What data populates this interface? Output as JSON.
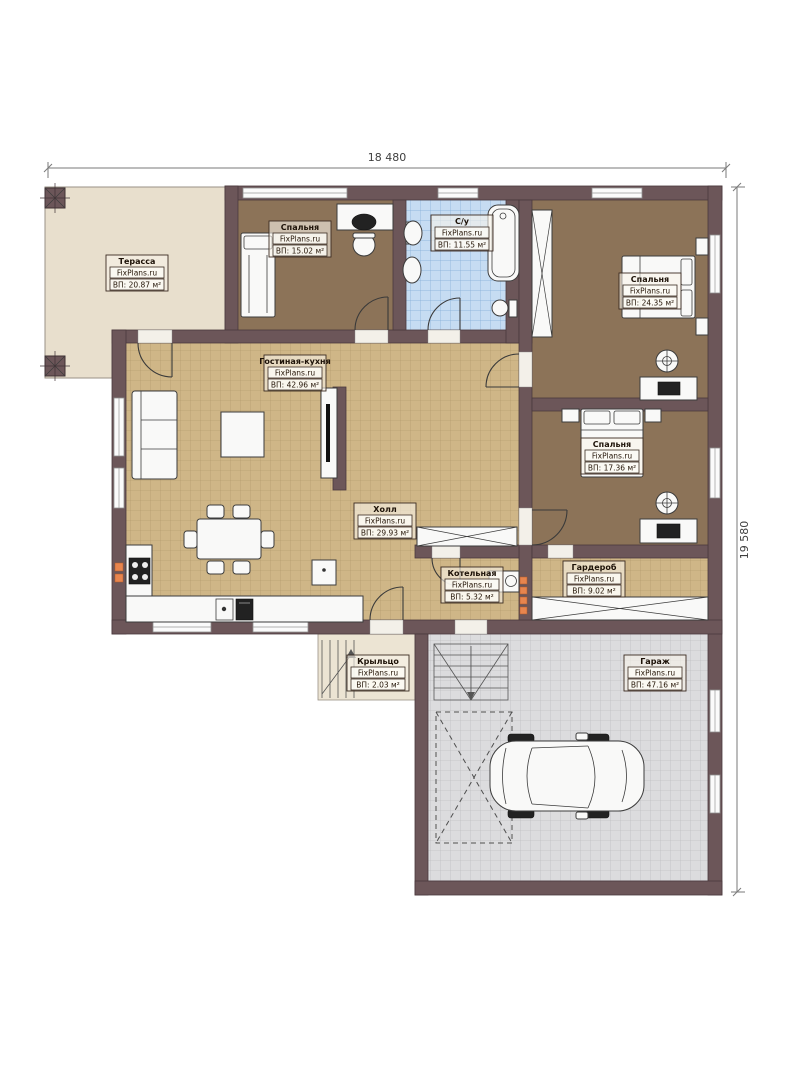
{
  "brand": "FixPlans.ru",
  "dimensions": {
    "width_label": "18 480",
    "height_label": "19 580"
  },
  "rooms": [
    {
      "name": "Терасса",
      "area": "ВП: 20.87 м²"
    },
    {
      "name": "Спальня",
      "area": "ВП: 15.02 м²"
    },
    {
      "name": "С/у",
      "area": "ВП: 11.55 м²"
    },
    {
      "name": "Спальня",
      "area": "ВП: 24.35 м²"
    },
    {
      "name": "Гостиная-кухня",
      "area": "ВП: 42.96 м²"
    },
    {
      "name": "Холл",
      "area": "ВП: 29.93 м²"
    },
    {
      "name": "Спальня",
      "area": "ВП: 17.36 м²"
    },
    {
      "name": "Котельная",
      "area": "ВП: 5.32 м²"
    },
    {
      "name": "Гардероб",
      "area": "ВП: 9.02 м²"
    },
    {
      "name": "Крыльцо",
      "area": "ВП: 2.03 м²"
    },
    {
      "name": "Гараж",
      "area": "ВП: 47.16 м²"
    }
  ],
  "colors": {
    "wall": "#6c5659",
    "bedroom_floor": "#8c7358",
    "living_floor": "#cfb687",
    "bathroom_floor": "#c6dcf2",
    "garage_floor": "#dcdcde",
    "terrace_floor": "#e8dfcd",
    "radiator": "#e8854e"
  }
}
